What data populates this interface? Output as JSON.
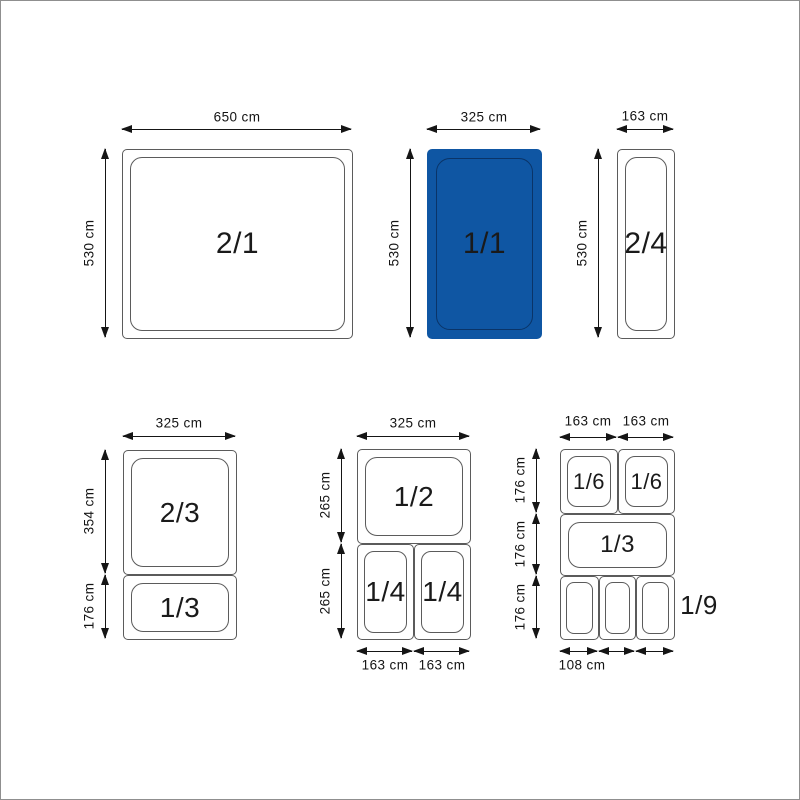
{
  "colors": {
    "highlight_fill": "#0f56a3",
    "highlight_inner_line": "#0a3468",
    "pan_line": "#5b5b5b",
    "arrow_and_text": "#141414",
    "background": "#ffffff"
  },
  "pans": {
    "gn21": {
      "label": "2/1",
      "width_dim": "650 cm",
      "height_dim": "530 cm"
    },
    "gn11": {
      "label": "1/1",
      "width_dim": "325 cm",
      "height_dim": "530 cm",
      "fill": "#0f56a3"
    },
    "gn24": {
      "label": "2/4",
      "width_dim": "163 cm",
      "height_dim": "530 cm"
    }
  },
  "groups": {
    "left": {
      "width_dim": "325 cm",
      "gn23": {
        "label": "2/3",
        "height_dim": "354 cm"
      },
      "gn13": {
        "label": "1/3",
        "height_dim": "176 cm"
      }
    },
    "middle": {
      "width_dim": "325 cm",
      "gn12": {
        "label": "1/2",
        "height_dim": "265 cm"
      },
      "row2_height_dim": "265 cm",
      "gn14_left": {
        "label": "1/4",
        "width_dim": "163 cm"
      },
      "gn14_right": {
        "label": "1/4",
        "width_dim": "163 cm"
      }
    },
    "right": {
      "col_left_dim": "163 cm",
      "col_right_dim": "163 cm",
      "row1_height_dim": "176 cm",
      "row2_height_dim": "176 cm",
      "row3_height_dim": "176 cm",
      "gn16_left": {
        "label": "1/6"
      },
      "gn16_right": {
        "label": "1/6"
      },
      "gn13": {
        "label": "1/3"
      },
      "gn19_label": "1/9",
      "gn19_width_dim": "108 cm"
    }
  }
}
